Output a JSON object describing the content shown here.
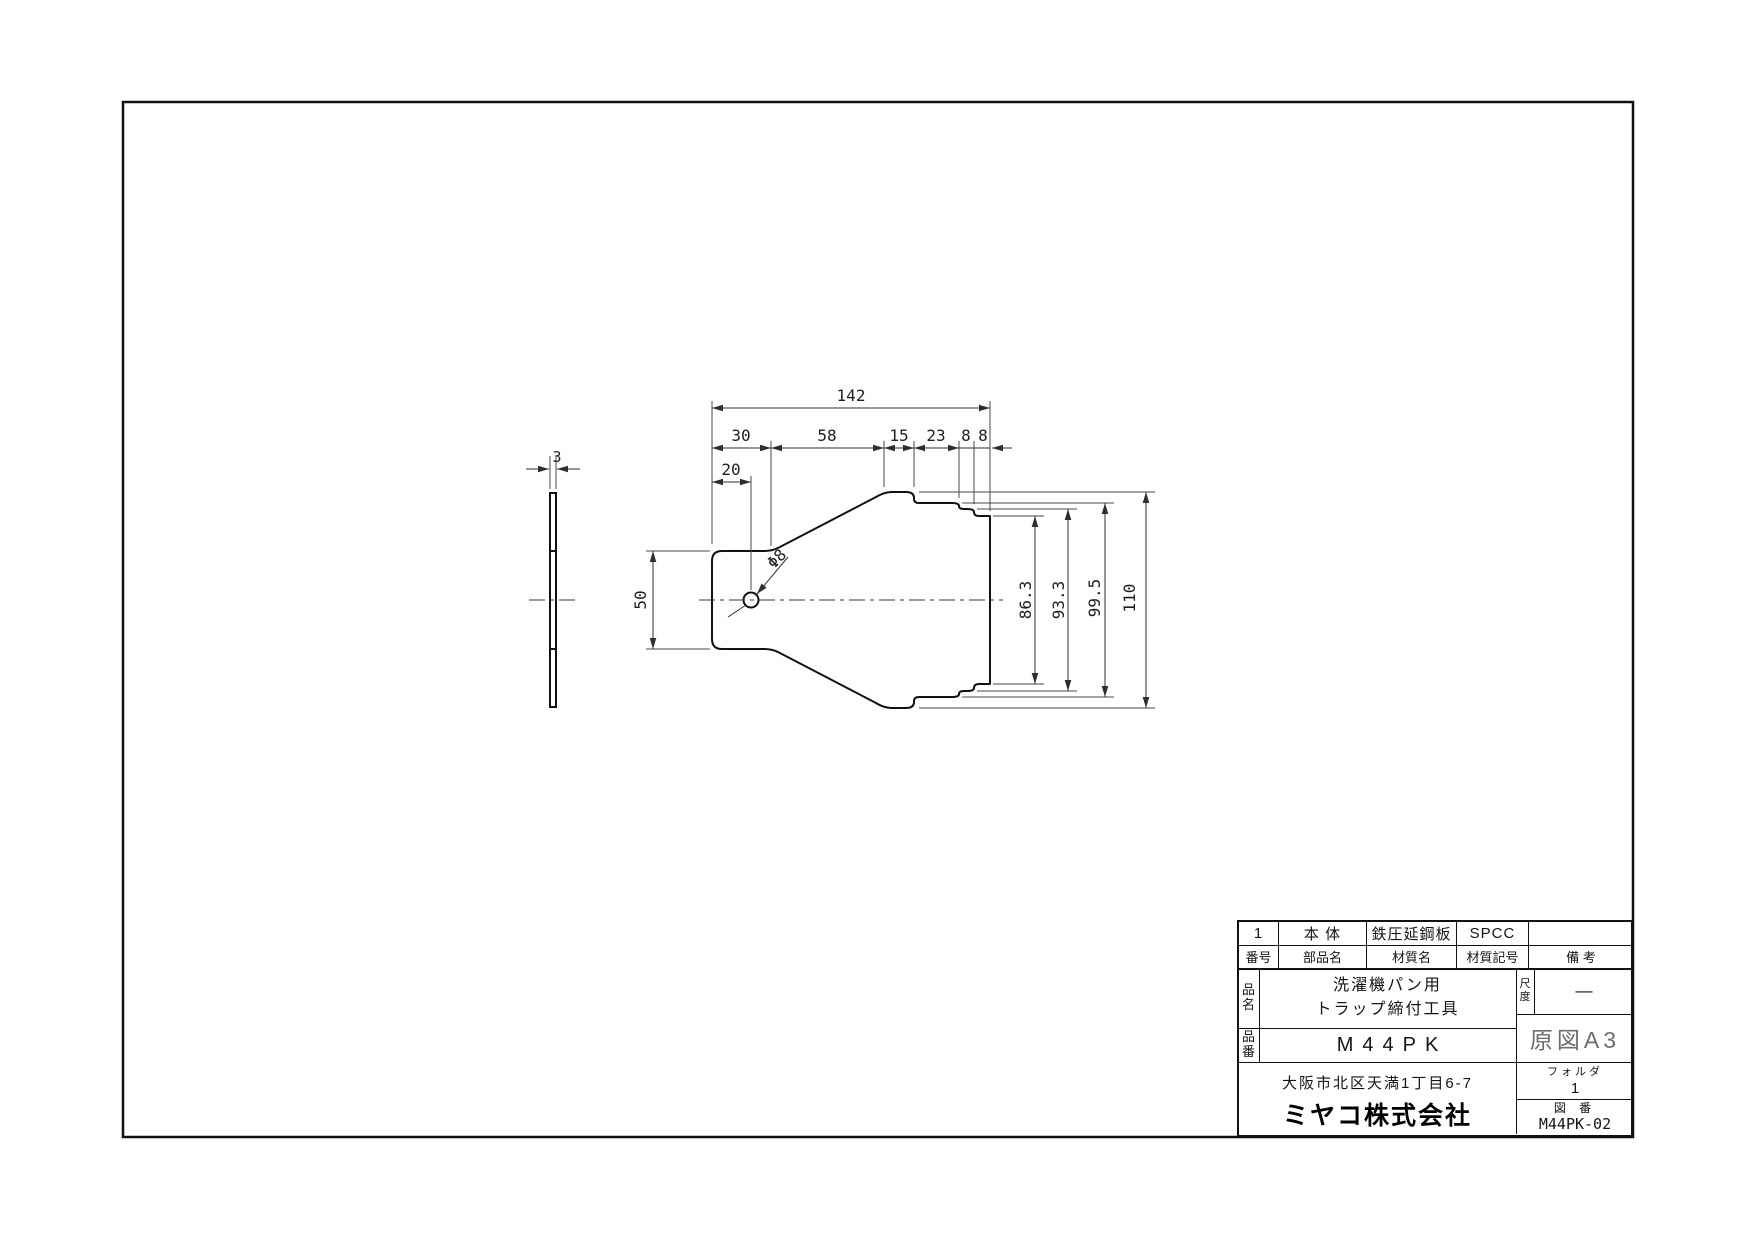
{
  "drawing": {
    "top_dim": "142",
    "chain_dims": [
      "30",
      "58",
      "15",
      "23",
      "8",
      "8"
    ],
    "hole_offset_dim": "20",
    "handle_height_dim": "50",
    "hole_label": "Φ8",
    "height_dims": [
      "86.3",
      "93.3",
      "99.5",
      "110"
    ],
    "thickness_dim": "3"
  },
  "title_block": {
    "parts_list": {
      "values": [
        "1",
        "本 体",
        "鉄圧延鋼板",
        "SPCC",
        ""
      ],
      "headers": [
        "番号",
        "部品名",
        "材質名",
        "材質記号",
        "備 考"
      ]
    },
    "product_name": {
      "label": "品名",
      "line1": "洗濯機パン用",
      "line2": "トラップ締付工具"
    },
    "product_code": {
      "label": "品番",
      "value": "M44PK"
    },
    "scale": {
      "label": "尺度",
      "value": "—"
    },
    "paper_size": "原図A3",
    "folder": {
      "label": "フォルダ",
      "value": "1"
    },
    "drawing_no": {
      "label": "図 番",
      "value": "M44PK-02"
    },
    "address": "大阪市北区天満1丁目6-7",
    "company": "ミヤコ株式会社"
  },
  "colors": {
    "outline": "#111111",
    "dimension": "#3a3a3a",
    "paper_size_text": "#6e6e6e"
  }
}
